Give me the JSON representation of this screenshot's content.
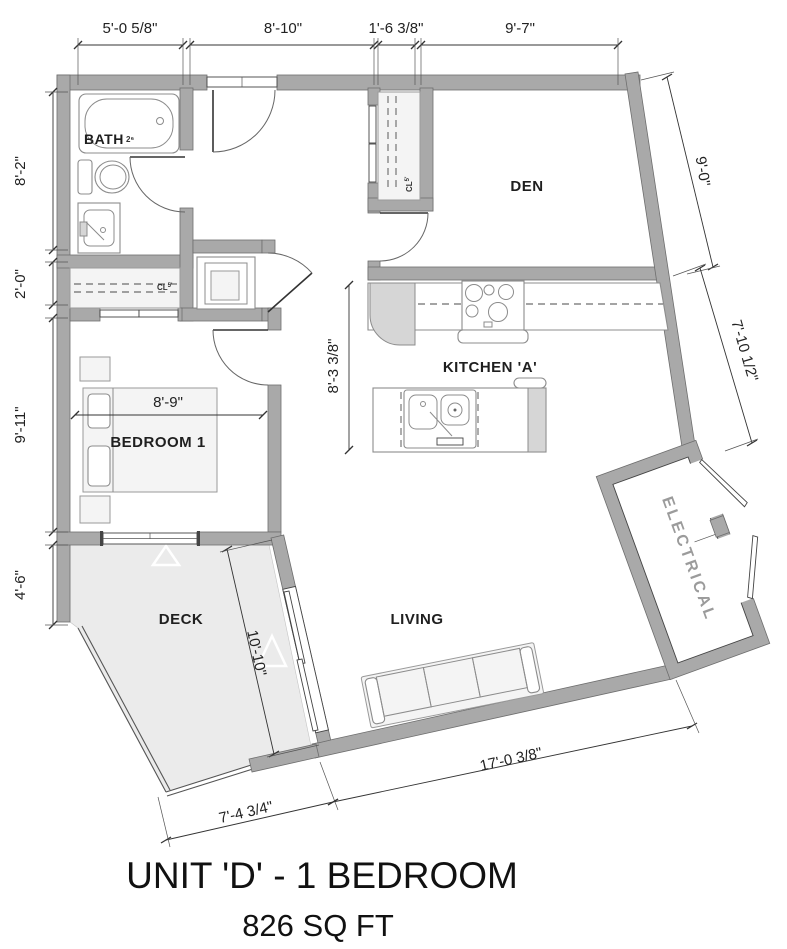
{
  "header": {
    "title": "UNIT 'D' - 1 BEDROOM",
    "area": "826 SQ FT"
  },
  "rooms": {
    "bath": {
      "label": "BATH",
      "tag": "2⁶"
    },
    "den": {
      "label": "DEN"
    },
    "kitchen": {
      "label": "KITCHEN 'A'"
    },
    "bedroom": {
      "label": "BEDROOM 1"
    },
    "living": {
      "label": "LIVING"
    },
    "deck": {
      "label": "DECK"
    },
    "electrical": {
      "label": "ELECTRICAL"
    },
    "bedroom_closet": {
      "label": "CL",
      "tag": "5'"
    },
    "den_closet": {
      "label": "CL",
      "tag": "5'"
    }
  },
  "dimensions": {
    "top": [
      "5'-0 5/8\"",
      "8'-10\"",
      "1'-6 3/8\"",
      "9'-7\""
    ],
    "left": [
      "8'-2\"",
      "2'-0\"",
      "9'-11\"",
      "4'-6\""
    ],
    "right": [
      "9'-0\"",
      "7'-10 1/2\""
    ],
    "interior": {
      "kitchen_depth": "8'-3 3/8\"",
      "bedroom_width": "8'-9\"",
      "deck_length": "10'-10\""
    },
    "bottom": {
      "living_width": "17'-0 3/8\"",
      "deck_width": "7'-4 3/4\""
    }
  },
  "colors": {
    "wall": "#a9a9a9",
    "wall_outline": "#6e6e6e",
    "deck_fill": "#ebebeb",
    "fixture_stroke": "#8c8c8c",
    "dimension_text": "#222222",
    "electrical_label": "#9b9b9b"
  }
}
